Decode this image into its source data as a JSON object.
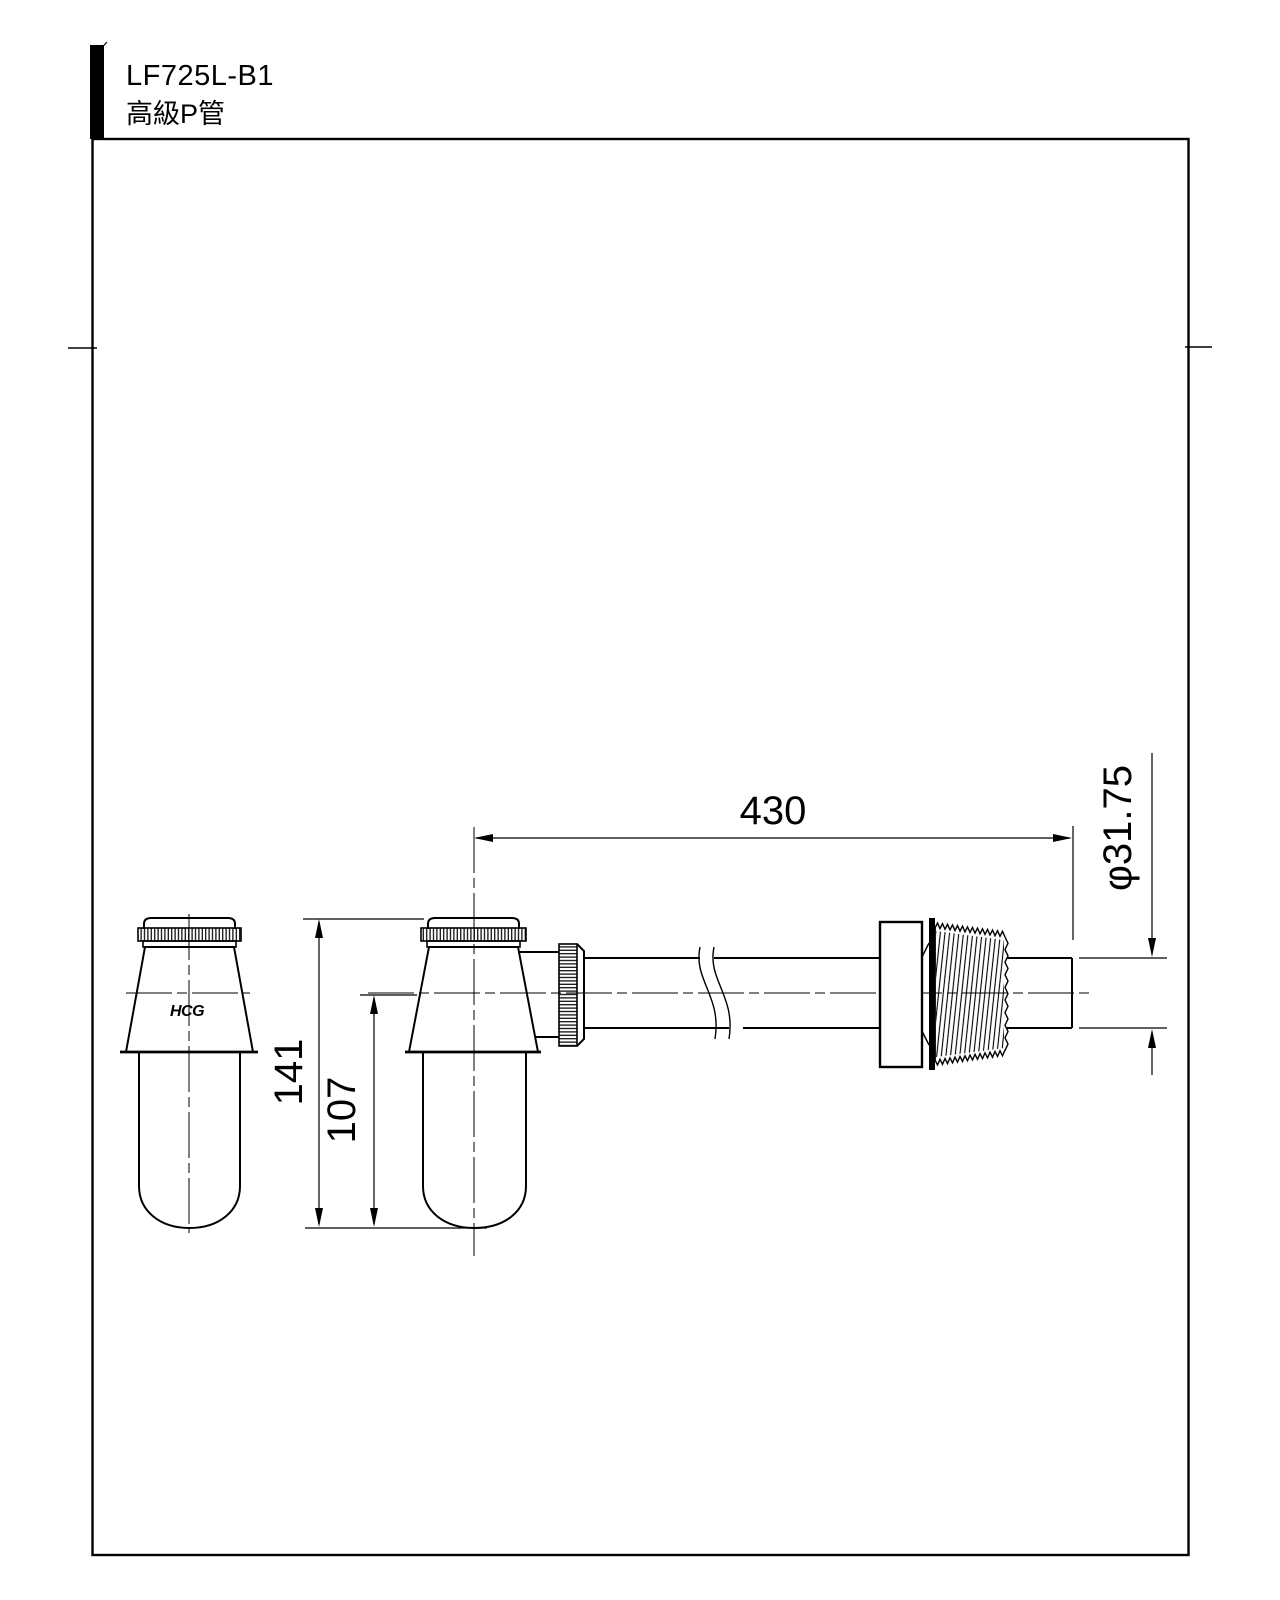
{
  "page": {
    "background": "#ffffff",
    "ink": "#000000"
  },
  "title_block": {
    "model": "LF725L-B1",
    "product_name": "高級P管"
  },
  "views": {
    "front": {
      "logo_text": "HCG"
    }
  },
  "dimensions": {
    "length_430": "430",
    "diameter": "φ31.75",
    "height_141": "141",
    "height_107": "107"
  }
}
